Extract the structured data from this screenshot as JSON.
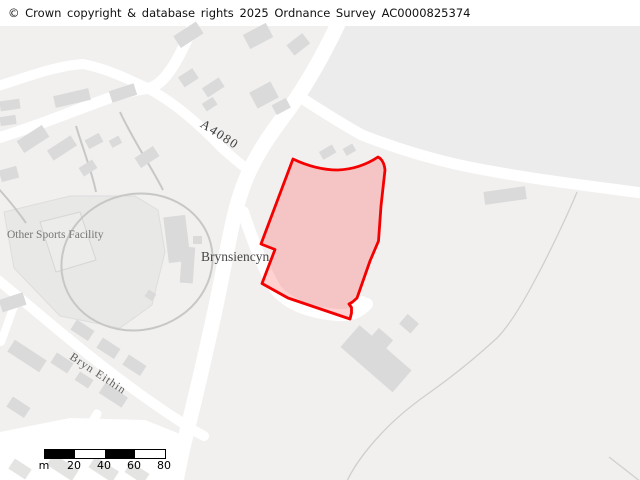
{
  "copyright_bar": {
    "text": "© Crown copyright & database rights 2025 Ordnance Survey AC0000825374"
  },
  "map": {
    "labels": {
      "road_number": "A4080",
      "settlement": "Brynsiencyn",
      "facility": "Other Sports Facility",
      "street": "Bryn Eithin"
    },
    "highlight": {
      "stroke_color": "#f40000",
      "fill_color": "rgba(255,45,45,0.22)"
    },
    "colors": {
      "background": "#f1f0ef",
      "background_ne_field": "#edecec",
      "building": "#dadada",
      "road": "#ffffff",
      "sports_area": "#e8e8e7",
      "path_line": "#c7c7c6",
      "boundary_line": "#cfcfce"
    }
  },
  "scale_bar": {
    "unit_label": "m",
    "tick_labels": [
      "20",
      "40",
      "60",
      "80"
    ]
  }
}
